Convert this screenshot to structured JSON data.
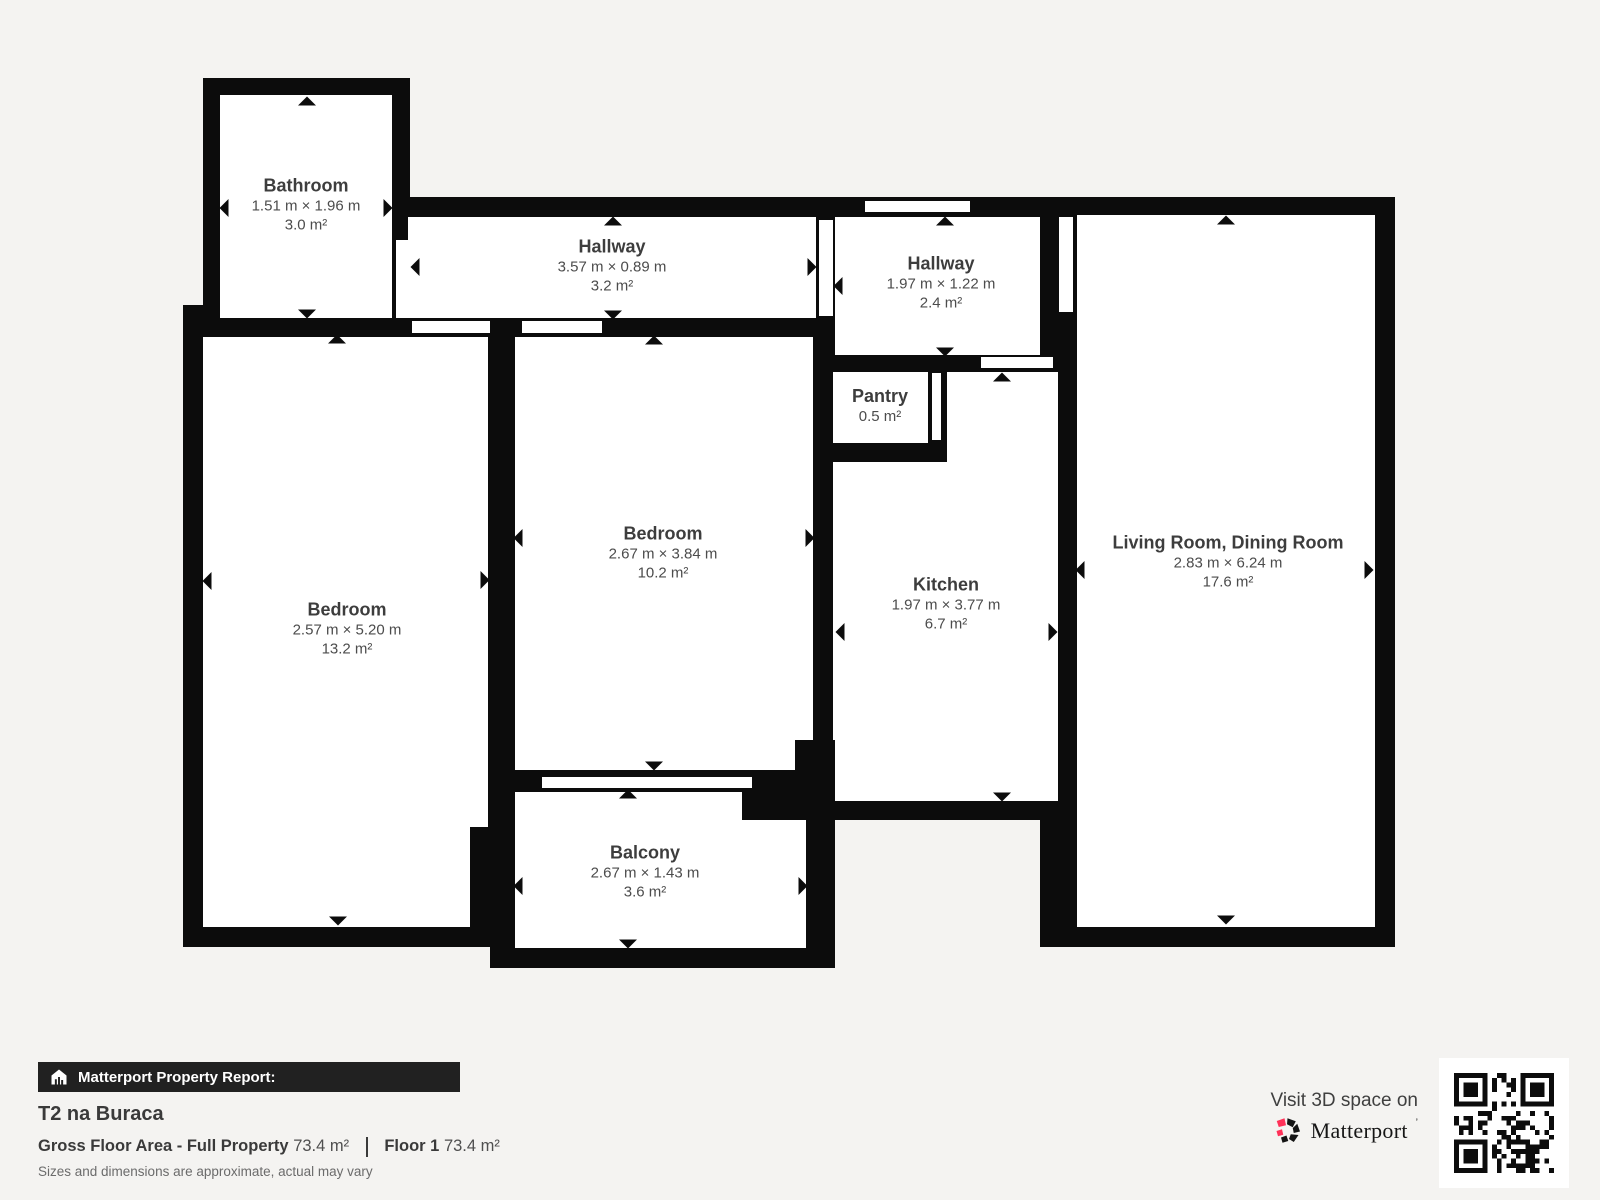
{
  "plan": {
    "rooms": [
      {
        "name": "Bathroom",
        "dims": "1.51 m × 1.96 m",
        "area": "3.0 m²"
      },
      {
        "name": "Hallway",
        "dims": "3.57 m × 0.89 m",
        "area": "3.2 m²"
      },
      {
        "name": "Hallway",
        "dims": "1.97 m × 1.22 m",
        "area": "2.4 m²"
      },
      {
        "name": "Pantry",
        "dims": "",
        "area": "0.5 m²"
      },
      {
        "name": "Kitchen",
        "dims": "1.97 m × 3.77 m",
        "area": "6.7 m²"
      },
      {
        "name": "Living Room, Dining Room",
        "dims": "2.83 m × 6.24 m",
        "area": "17.6 m²"
      },
      {
        "name": "Bedroom",
        "dims": "2.57 m × 5.20 m",
        "area": "13.2 m²"
      },
      {
        "name": "Bedroom",
        "dims": "2.67 m × 3.84 m",
        "area": "10.2 m²"
      },
      {
        "name": "Balcony",
        "dims": "2.67 m × 1.43 m",
        "area": "3.6 m²"
      }
    ]
  },
  "footer": {
    "report_label": "Matterport Property Report:",
    "property_name": "T2 na Buraca",
    "gfa_label": "Gross Floor Area - Full Property",
    "gfa_value": "73.4 m²",
    "floor_label": "Floor 1",
    "floor_value": "73.4 m²",
    "disclaimer": "Sizes and dimensions are approximate, actual may vary",
    "visit_text": "Visit 3D space on",
    "brand": "Matterport",
    "brand_mark": "ʼ"
  },
  "colors": {
    "wall": "#0c0c0c",
    "floor": "#ffffff",
    "background": "#f4f3f1",
    "accent_pink": "#ff3158",
    "bar_background": "#212121"
  }
}
